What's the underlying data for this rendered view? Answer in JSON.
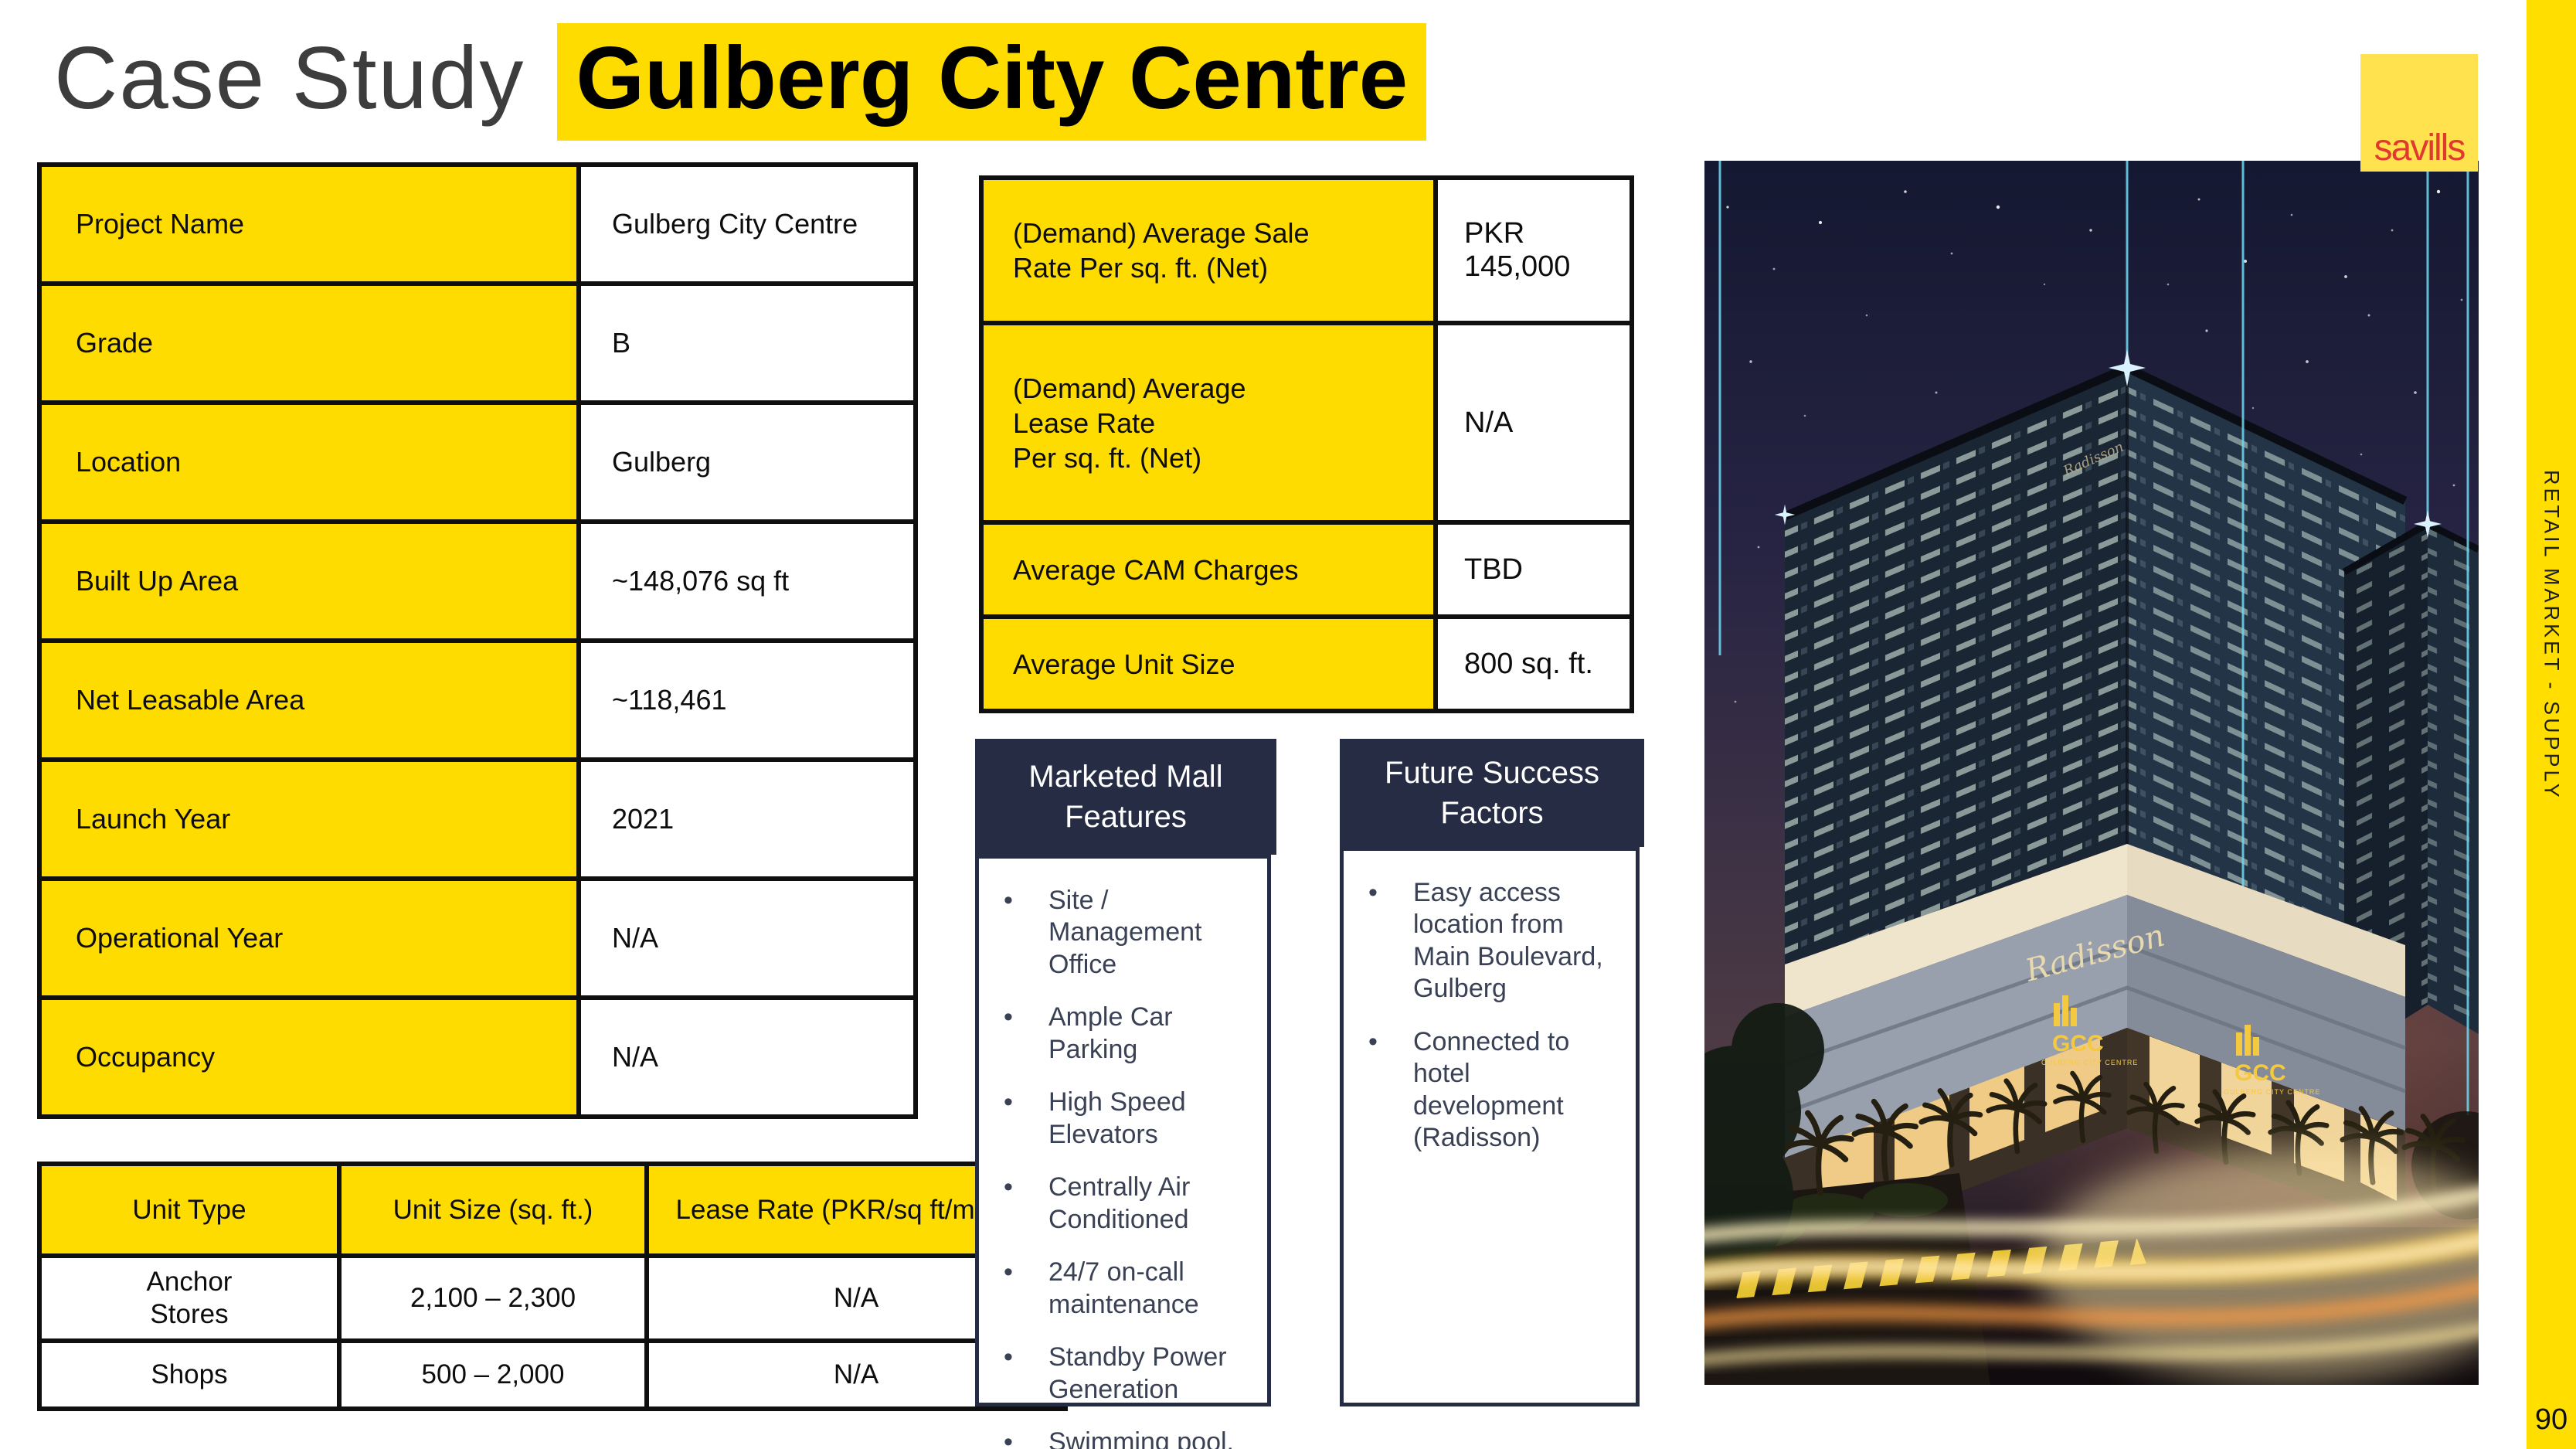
{
  "title": {
    "prefix": "Case Study",
    "highlight": "Gulberg City Centre"
  },
  "project_table": {
    "rows": [
      {
        "label": "Project Name",
        "value": "Gulberg City Centre"
      },
      {
        "label": "Grade",
        "value": "B"
      },
      {
        "label": "Location",
        "value": "Gulberg"
      },
      {
        "label": "Built Up Area",
        "value": "~148,076 sq ft"
      },
      {
        "label": "Net Leasable Area",
        "value": "~118,461"
      },
      {
        "label": "Launch Year",
        "value": "2021"
      },
      {
        "label": "Operational Year",
        "value": "N/A"
      },
      {
        "label": "Occupancy",
        "value": "N/A"
      }
    ]
  },
  "demand_table": {
    "rows": [
      {
        "label": "(Demand) Average Sale\nRate Per sq. ft. (Net)",
        "value": "PKR 145,000"
      },
      {
        "label": "(Demand) Average\nLease Rate\nPer sq. ft. (Net)",
        "value": "N/A"
      },
      {
        "label": "Average CAM Charges",
        "value": "TBD"
      },
      {
        "label": "Average Unit Size",
        "value": "800 sq. ft."
      }
    ]
  },
  "unit_table": {
    "headers": [
      "Unit Type",
      "Unit Size (sq. ft.)",
      "Lease Rate (PKR/sq ft/month)"
    ],
    "rows": [
      [
        "Anchor\nStores",
        "2,100 – 2,300",
        "N/A"
      ],
      [
        "Shops",
        "500 – 2,000",
        "N/A"
      ]
    ]
  },
  "mall_features": {
    "title": "Marketed Mall Features",
    "items": [
      "Site / Management Office",
      "Ample Car Parking",
      "High Speed Elevators",
      "Centrally Air Conditioned",
      "24/7 on-call maintenance",
      "Standby Power Generation",
      "Swimming pool, gym, spa"
    ]
  },
  "success_factors": {
    "title": "Future Success Factors",
    "items": [
      "Easy access location from Main Boulevard, Gulberg",
      "Connected to hotel development (Radisson)"
    ]
  },
  "building": {
    "signs": {
      "radisson": "Radisson",
      "gcc": "GCC",
      "gcc_caption": "GULBERG CITY CENTRE"
    }
  },
  "branding": {
    "logo_text": "savills",
    "sidebar_text": "RETAIL MARKET - SUPPLY",
    "page_number": "90"
  },
  "colors": {
    "accent_yellow": "#FFDC00",
    "header_navy": "#262C44",
    "logo_yellow": "#FFE24D",
    "logo_red": "#E0392E",
    "sidebar_yellow": "#FFDE00",
    "beam_cyan": "#6FD8F2"
  }
}
